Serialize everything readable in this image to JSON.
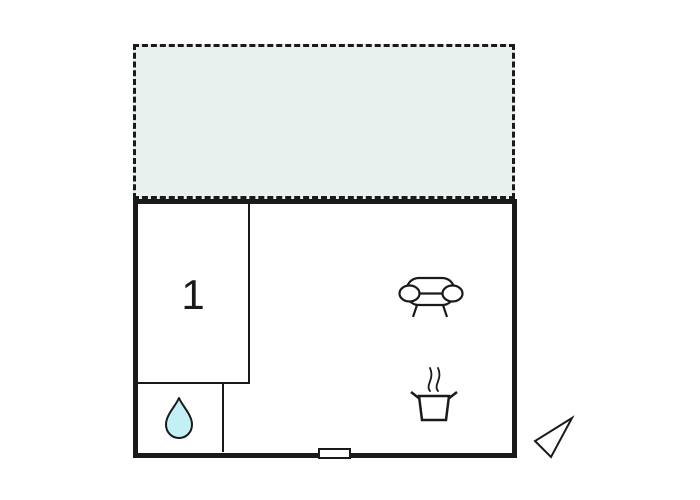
{
  "floor_plan": {
    "room_label": "1",
    "rooms": {
      "room1": {
        "label": "1"
      },
      "bathroom": {
        "icon": "water-drop-icon"
      },
      "main_area": {
        "icons": [
          "sofa-icon",
          "cooking-pot-icon"
        ]
      },
      "terrace": {
        "style": "dashed-outline-shaded"
      }
    },
    "markers": {
      "entrance": "door-marker",
      "orientation": "north-arrow-icon"
    },
    "colors": {
      "background": "#ffffff",
      "wall": "#1a1a1a",
      "terrace_fill": "#e9f1ef",
      "water_drop_fill": "#c3f0f5"
    }
  }
}
